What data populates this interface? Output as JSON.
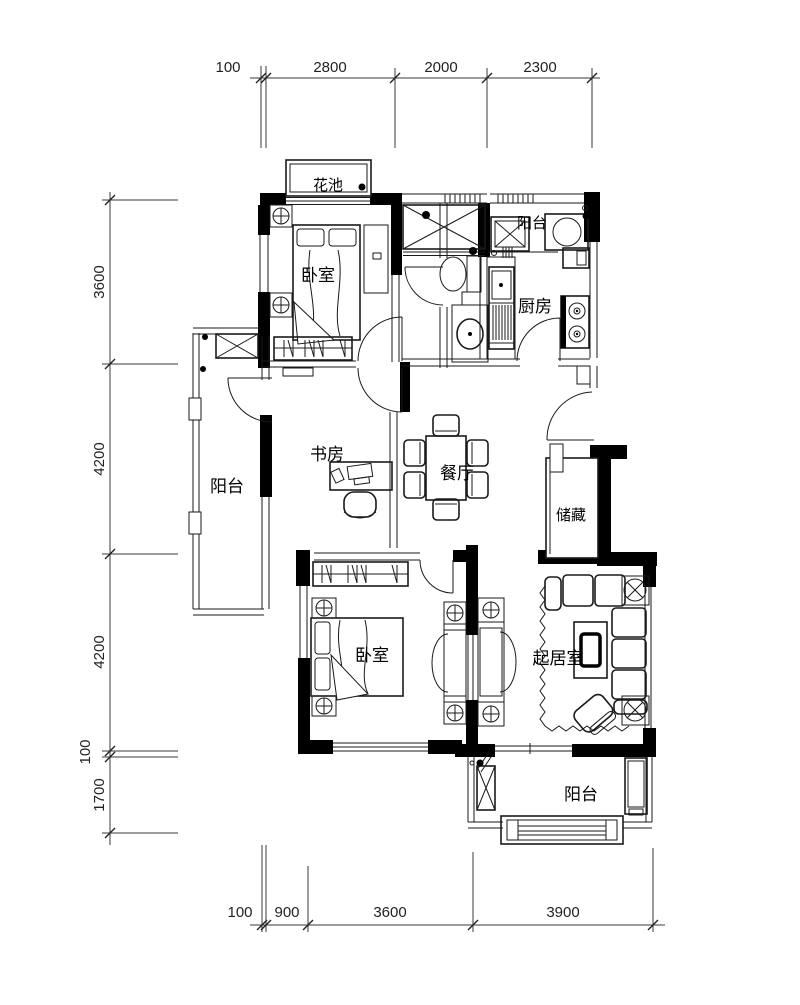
{
  "rooms": {
    "flower_bed": "花池",
    "balcony_top": "阳台",
    "bedroom_top": "卧室",
    "kitchen": "厨房",
    "balcony_left": "阳台",
    "study": "书房",
    "dining_room": "餐厅",
    "storage": "储藏",
    "bedroom_bottom": "卧室",
    "living_room": "起居室",
    "balcony_bottom": "阳台"
  },
  "dimensions": {
    "top": [
      "100",
      "2800",
      "2000",
      "2300"
    ],
    "left": [
      "3600",
      "4200",
      "4200",
      "100",
      "1700"
    ],
    "bottom": [
      "100",
      "900",
      "3600",
      "3900"
    ]
  },
  "colors": {
    "wall": "#000000",
    "line": "#1a1a1a",
    "dimension": "#222222",
    "background": "#ffffff"
  }
}
